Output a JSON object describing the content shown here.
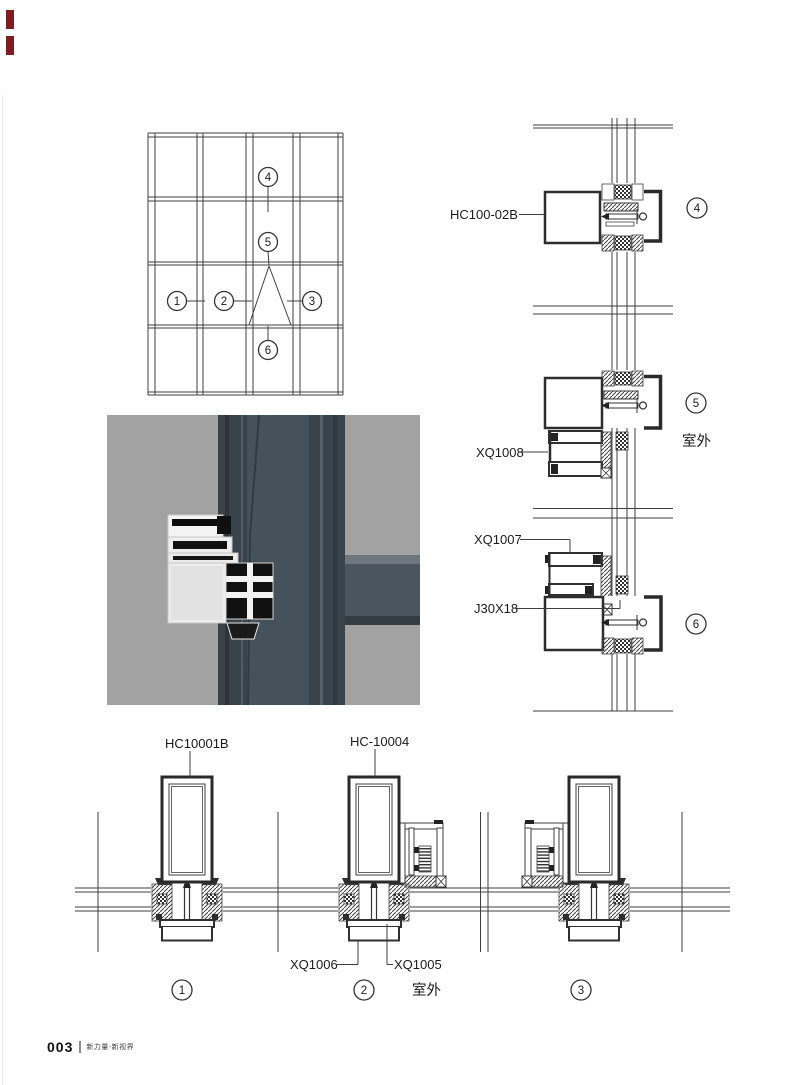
{
  "figure_labels": {
    "hc100_02b": "HC100-02B",
    "xq1008": "XQ1008",
    "xq1007": "XQ1007",
    "j30x18": "J30X18",
    "hc10001b": "HC10001B",
    "hc_10004": "HC-10004",
    "xq1006": "XQ1006",
    "xq1005": "XQ1005"
  },
  "annotations": {
    "outdoor_right": "室外",
    "outdoor_bottom": "室外"
  },
  "callouts": {
    "n1": "1",
    "n2": "2",
    "n3": "3",
    "n4": "4",
    "n5": "5",
    "n6": "6"
  },
  "section_markers": {
    "right_top": "4",
    "right_mid": "5",
    "right_bottom": "6",
    "bottom_left": "1",
    "bottom_mid": "2",
    "bottom_right": "3"
  },
  "colors": {
    "page_edge_mark": "#7e1c21",
    "line": "#3f3f3f",
    "photo_background": "#a2a2a2",
    "photo_profile": "#3a444c"
  },
  "footer": {
    "page_number": "003",
    "journal_title": "新力量·新视界"
  }
}
